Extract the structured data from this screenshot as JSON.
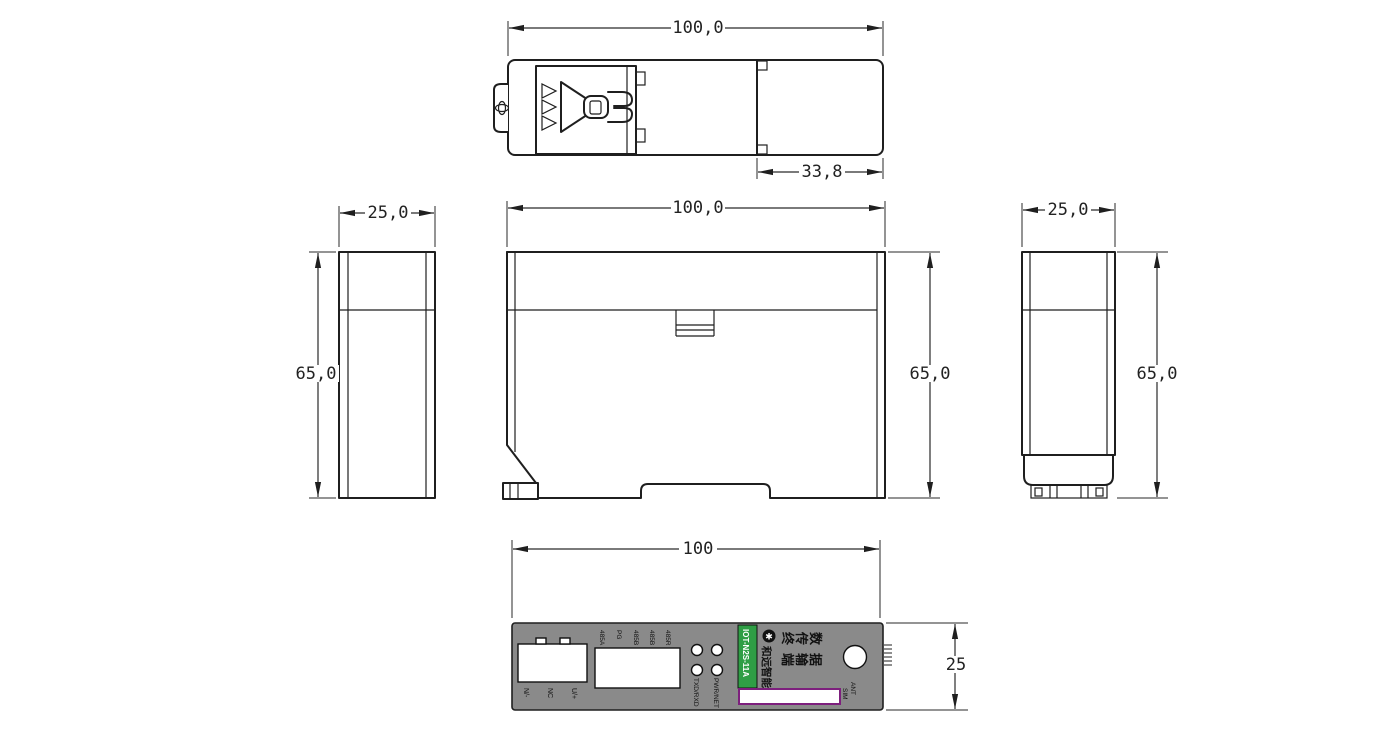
{
  "dimensions": {
    "top_width": "100,0",
    "top_clip_width": "33,8",
    "left_width": "25,0",
    "left_height": "65,0",
    "front_width": "100,0",
    "front_height": "65,0",
    "right_width": "25,0",
    "right_height": "65,0",
    "bottom_width": "100",
    "bottom_height": "25"
  },
  "panel": {
    "power_terminal_labels": [
      "N/-",
      "NC",
      "U/+"
    ],
    "io_terminal_labels": [
      "485A",
      "PG",
      "485B",
      "485B",
      "485R"
    ],
    "led_labels": [
      "TXD/RXD",
      "PWR/NET"
    ],
    "model": "IOT-N2S-11A",
    "brand": "和远智能",
    "logo_glyph": "✱",
    "product_name_lines": [
      "数据",
      "传输",
      "终端"
    ],
    "ant_label": "ANT",
    "sim_label": "SIM",
    "colors": {
      "panel_gray": "#8a8a8a",
      "model_green": "#2f9e45",
      "sim_border": "#7d1f7d"
    }
  }
}
